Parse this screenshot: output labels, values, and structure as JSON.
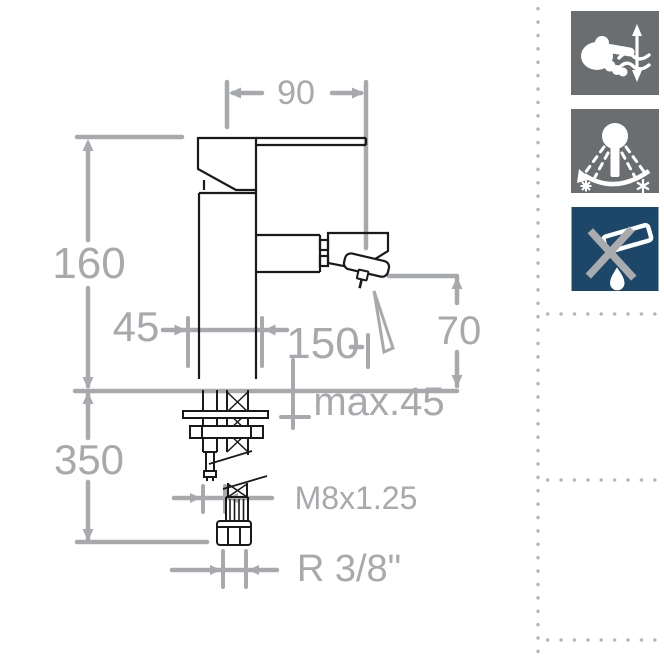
{
  "page": {
    "background": "#ffffff",
    "description": "Technical dimension drawing of a single-lever bidet/basin mixer tap with feature icons"
  },
  "drawing": {
    "dimensions": {
      "spout_reach": "90",
      "total_height": "160",
      "base_width": "45",
      "spout_center_distance": "150",
      "outlet_to_deck_height": "70",
      "max_deck_thickness": "max.45",
      "supply_hose_length": "350",
      "fixing_stud_thread": "M8x1.25",
      "hose_connection_thread": "R 3/8\""
    }
  },
  "icons": [
    {
      "name": "single-lever-flow-control",
      "bg": "#6b6e70",
      "glyph": "hand-moving-lever-with-water-waves-and-up-down-arrow"
    },
    {
      "name": "temperature-adjustment",
      "bg": "#6b6e70",
      "glyph": "cartridge-with-spray-arc-between-hot-and-cold"
    },
    {
      "name": "no-pop-up-waste",
      "bg": "#1c4769",
      "glyph": "crossed-out-waste-plug-with-water-drop"
    }
  ],
  "colors": {
    "outline_black": "#1a1a1a",
    "dimension_gray": "#a7a9ac",
    "dotted_border_gray": "#b3b5b7",
    "icon_gray": "#6b6e70",
    "icon_blue": "#1c4769"
  }
}
